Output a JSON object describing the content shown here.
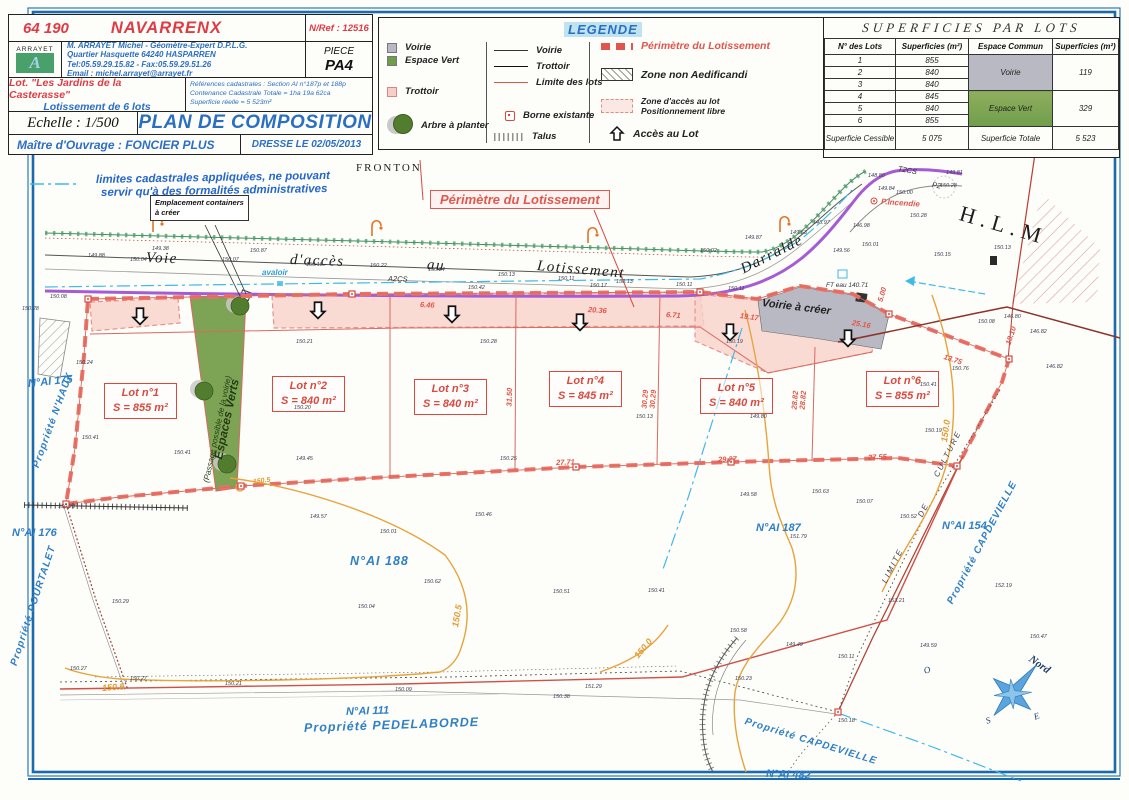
{
  "title_block": {
    "code": "64 190",
    "commune": "NAVARRENX",
    "nref": "N/Ref : 12516",
    "logo_text": "ARRAYET",
    "logo_letter": "A",
    "surveyor_line1": "M. ARRAYET Michel - Géomètre-Expert D.P.L.G.",
    "surveyor_line2": "Quartier Hasquette 64240 HASPARREN",
    "surveyor_line3": "Tel:05.59.29.15.82 - Fax:05.59.29.51.26",
    "surveyor_line4": "Email : michel.arrayet@arrayet.fr",
    "piece_label": "PIECE",
    "piece_value": "PA4",
    "lot_name": "Lot. \"Les Jardins de la Casterasse\"",
    "lot_sub": "Lotissement de 6 lots",
    "cadastre_line1": "Références cadastrales : Section AI n°187p et 188p",
    "cadastre_line2": "Contenance Cadastrale Totale = 1ha 19a 62ca",
    "cadastre_line3": "Superficie réelle = 5 523m²",
    "echelle": "Echelle : 1/500",
    "doc_title": "PLAN DE COMPOSITION",
    "client": "Maître d'Ouvrage : FONCIER PLUS",
    "date": "DRESSE LE 02/05/2013"
  },
  "legend": {
    "title": "LEGENDE",
    "col1": [
      {
        "label": "Voirie"
      },
      {
        "label": "Espace Vert"
      },
      {
        "label": "Trottoir"
      },
      {
        "label": "Arbre à planter"
      }
    ],
    "col2": [
      {
        "label": "Voirie"
      },
      {
        "label": "Trottoir"
      },
      {
        "label": "Limite des lots"
      },
      {
        "label": "Borne existante"
      },
      {
        "label": "Talus"
      }
    ],
    "col3": [
      {
        "label": "Périmètre du Lotissement"
      },
      {
        "label": "Zone non Aedificandi"
      },
      {
        "label": "Zone d'accès au lot",
        "label2": "Positionnement libre"
      },
      {
        "label": "Accès au Lot"
      }
    ]
  },
  "table": {
    "title": "SUPERFICIES PAR LOTS",
    "headers": [
      "N° des Lots",
      "Superficies (m²)",
      "Espace Commun",
      "Superficies (m²)"
    ],
    "rows": [
      [
        "1",
        "855"
      ],
      [
        "2",
        "840"
      ],
      [
        "3",
        "840"
      ],
      [
        "4",
        "845"
      ],
      [
        "5",
        "840"
      ],
      [
        "6",
        "855"
      ]
    ],
    "voirie_label": "Voirie",
    "voirie_value": "119",
    "ev_label": "Espace Vert",
    "ev_value": "329",
    "cessible_label": "Superficie Cessible",
    "cessible_value": "5 075",
    "totale_label": "Superficie Totale",
    "totale_value": "5 523"
  },
  "plan": {
    "containers_line1": "Emplacement containers",
    "containers_line2": "à créer",
    "perimetre_label": "Périmètre du Lotissement",
    "lots": [
      {
        "name": "Lot n°1",
        "area": "S = 855 m²",
        "x": 104,
        "y": 383
      },
      {
        "name": "Lot n°2",
        "area": "S = 840 m²",
        "x": 272,
        "y": 376
      },
      {
        "name": "Lot n°3",
        "area": "S = 840 m²",
        "x": 414,
        "y": 379
      },
      {
        "name": "Lot n°4",
        "area": "S = 845 m²",
        "x": 549,
        "y": 371
      },
      {
        "name": "Lot n°5",
        "area": "S = 840 m²",
        "x": 700,
        "y": 378
      },
      {
        "name": "Lot n°6",
        "area": "S = 855 m²",
        "x": 866,
        "y": 371
      }
    ],
    "labels": [
      {
        "t": "FRONTON",
        "x": 356,
        "y": 162,
        "r": 0,
        "c": "serifcap",
        "n": "fronton-label"
      },
      {
        "t": "limites cadastrales appliquées, ne pouvant",
        "x": 96,
        "y": 174,
        "r": -1,
        "c": "note",
        "n": "cadastral-note-line1"
      },
      {
        "t": "servir qu'à des formalités administratives",
        "x": 101,
        "y": 187,
        "r": -1,
        "c": "note",
        "n": "cadastral-note-line2"
      },
      {
        "t": "Voie",
        "x": 146,
        "y": 250,
        "r": 2,
        "c": "road",
        "n": "road-name"
      },
      {
        "t": "d'accès",
        "x": 290,
        "y": 252,
        "r": 2,
        "c": "road",
        "n": "road-name"
      },
      {
        "t": "au",
        "x": 427,
        "y": 257,
        "r": 4,
        "c": "road",
        "n": "road-name"
      },
      {
        "t": "Lotissement",
        "x": 537,
        "y": 258,
        "r": 5,
        "c": "road",
        "n": "road-name"
      },
      {
        "t": "Darralde",
        "x": 742,
        "y": 262,
        "r": -27,
        "c": "road",
        "n": "road-name-darralde"
      },
      {
        "t": "A2CS",
        "x": 388,
        "y": 274,
        "r": 2,
        "c": "tinyital",
        "n": "network-label"
      },
      {
        "t": "T2CS",
        "x": 898,
        "y": 164,
        "r": 10,
        "c": "tinyital",
        "n": "network-label"
      },
      {
        "t": "P2",
        "x": 932,
        "y": 180,
        "r": 10,
        "c": "tinyital",
        "n": "network-label"
      },
      {
        "t": "P.Incendie",
        "x": 881,
        "y": 197,
        "r": 4,
        "c": "redtiny",
        "n": "hydrant-label"
      },
      {
        "t": "H.L.M",
        "x": 960,
        "y": 200,
        "r": 16,
        "c": "hlm",
        "n": "hlm-label"
      },
      {
        "t": "Voirie à créer",
        "x": 762,
        "y": 297,
        "r": 7,
        "c": "voirie-creer",
        "n": "voirie-a-creer-label"
      },
      {
        "t": "avaloir",
        "x": 262,
        "y": 268,
        "r": 0,
        "c": "bluetiny",
        "n": "avaloir-label"
      },
      {
        "t": "FT eau 140.71",
        "x": 826,
        "y": 282,
        "r": 0,
        "c": "microital",
        "n": "ft-eau-label"
      },
      {
        "t": "Espaces Verts",
        "x": 218,
        "y": 452,
        "r": -78,
        "c": "ev1",
        "n": "espaces-verts-label"
      },
      {
        "t": "(Passage possible de la voirie)",
        "x": 206,
        "y": 478,
        "r": -78,
        "c": "ev2",
        "n": "espaces-verts-sublabel"
      },
      {
        "t": "N°AI 175",
        "x": 28,
        "y": 378,
        "r": -6,
        "c": "blue",
        "n": "parcel-number"
      },
      {
        "t": "Propriété N'HAUX",
        "x": 36,
        "y": 462,
        "r": -70,
        "c": "blue-rot",
        "n": "property-label"
      },
      {
        "t": "N°AI 176",
        "x": 12,
        "y": 527,
        "r": 0,
        "c": "blue",
        "n": "parcel-number"
      },
      {
        "t": "Propriété POURTALET",
        "x": 14,
        "y": 660,
        "r": -72,
        "c": "blue-rot",
        "n": "property-label"
      },
      {
        "t": "N°AI 188",
        "x": 350,
        "y": 554,
        "r": 0,
        "c": "blue-lg",
        "n": "parcel-number"
      },
      {
        "t": "N°AI 187",
        "x": 756,
        "y": 522,
        "r": 0,
        "c": "blue",
        "n": "parcel-number"
      },
      {
        "t": "N°AI 154",
        "x": 942,
        "y": 520,
        "r": 0,
        "c": "blue",
        "n": "parcel-number"
      },
      {
        "t": "Propriété CAPDEVIELLE",
        "x": 950,
        "y": 598,
        "r": -62,
        "c": "blue-rot",
        "n": "property-label"
      },
      {
        "t": "N°AI 111",
        "x": 346,
        "y": 706,
        "r": -2,
        "c": "blue",
        "n": "parcel-number"
      },
      {
        "t": "Propriété  PEDELABORDE",
        "x": 304,
        "y": 721,
        "r": -2,
        "c": "blue-lg",
        "n": "property-label"
      },
      {
        "t": "Propriété CAPDEVIELLE",
        "x": 745,
        "y": 716,
        "r": 17,
        "c": "blue-rot",
        "n": "property-label"
      },
      {
        "t": "N°AI 482",
        "x": 766,
        "y": 768,
        "r": 2,
        "c": "blue",
        "n": "parcel-number"
      },
      {
        "t": "LIMITE",
        "x": 884,
        "y": 578,
        "r": -63,
        "c": "culture",
        "n": "limite-culture-label"
      },
      {
        "t": "DE",
        "x": 920,
        "y": 512,
        "r": -63,
        "c": "culture",
        "n": "limite-culture-label"
      },
      {
        "t": "CULTURE",
        "x": 936,
        "y": 472,
        "r": -63,
        "c": "culture",
        "n": "limite-culture-label"
      },
      {
        "t": "Nord",
        "x": 1030,
        "y": 652,
        "r": 35,
        "c": "nord",
        "n": "compass-north-label"
      },
      {
        "t": "O",
        "x": 924,
        "y": 666,
        "r": -20,
        "c": "cletter",
        "n": "compass-west-label"
      },
      {
        "t": "S",
        "x": 986,
        "y": 716,
        "r": -20,
        "c": "cletter",
        "n": "compass-south-label"
      },
      {
        "t": "E",
        "x": 1034,
        "y": 712,
        "r": -20,
        "c": "cletter",
        "n": "compass-east-label"
      },
      {
        "t": "150.5",
        "x": 102,
        "y": 683,
        "r": -4,
        "c": "orange",
        "n": "contour-label"
      },
      {
        "t": "150.5",
        "x": 253,
        "y": 479,
        "r": -8,
        "c": "orange-sm",
        "n": "contour-label"
      },
      {
        "t": "150.5",
        "x": 455,
        "y": 622,
        "r": -80,
        "c": "orange",
        "n": "contour-label"
      },
      {
        "t": "150.0",
        "x": 944,
        "y": 437,
        "r": -82,
        "c": "orange",
        "n": "contour-label"
      },
      {
        "t": "150.0",
        "x": 636,
        "y": 652,
        "r": -50,
        "c": "orange",
        "n": "contour-label"
      },
      {
        "t": "6.46",
        "x": 420,
        "y": 300,
        "r": 3,
        "c": "dim",
        "n": "dimension"
      },
      {
        "t": "20.36",
        "x": 588,
        "y": 305,
        "r": 4,
        "c": "dim",
        "n": "dimension"
      },
      {
        "t": "6.71",
        "x": 666,
        "y": 310,
        "r": 4,
        "c": "dim",
        "n": "dimension"
      },
      {
        "t": "19.17",
        "x": 740,
        "y": 311,
        "r": 8,
        "c": "dim",
        "n": "dimension"
      },
      {
        "t": "25.16",
        "x": 852,
        "y": 318,
        "r": 10,
        "c": "dim",
        "n": "dimension"
      },
      {
        "t": "13.75",
        "x": 944,
        "y": 352,
        "r": 18,
        "c": "dim",
        "n": "dimension"
      },
      {
        "t": "18.10",
        "x": 1008,
        "y": 340,
        "r": -72,
        "c": "dim",
        "n": "dimension"
      },
      {
        "t": "31.50",
        "x": 509,
        "y": 402,
        "r": -88,
        "c": "dim",
        "n": "dimension"
      },
      {
        "t": "30.29",
        "x": 644,
        "y": 404,
        "r": -85,
        "c": "dim",
        "n": "dimension"
      },
      {
        "t": "30.29",
        "x": 652,
        "y": 404,
        "r": -85,
        "c": "dim",
        "n": "dimension"
      },
      {
        "t": "28.82",
        "x": 794,
        "y": 405,
        "r": -85,
        "c": "dim",
        "n": "dimension"
      },
      {
        "t": "28.82",
        "x": 802,
        "y": 405,
        "r": -85,
        "c": "dim",
        "n": "dimension"
      },
      {
        "t": "27.71",
        "x": 556,
        "y": 458,
        "r": -2,
        "c": "dim",
        "n": "dimension"
      },
      {
        "t": "29.27",
        "x": 718,
        "y": 455,
        "r": -2,
        "c": "dim",
        "n": "dimension"
      },
      {
        "t": "27.55",
        "x": 868,
        "y": 453,
        "r": -3,
        "c": "dim",
        "n": "dimension"
      },
      {
        "t": "5.00",
        "x": 880,
        "y": 297,
        "r": -74,
        "c": "dim",
        "n": "dimension"
      }
    ],
    "spots": [
      [
        88,
        254,
        "149.88"
      ],
      [
        130,
        258,
        "150.04"
      ],
      [
        152,
        247,
        "149.38"
      ],
      [
        222,
        258,
        "150.07"
      ],
      [
        250,
        249,
        "150.87"
      ],
      [
        306,
        263,
        "150.18"
      ],
      [
        370,
        264,
        "150.22"
      ],
      [
        428,
        268,
        "150.24"
      ],
      [
        468,
        286,
        "150.42"
      ],
      [
        498,
        273,
        "150.13"
      ],
      [
        558,
        277,
        "150.11"
      ],
      [
        590,
        284,
        "150.17"
      ],
      [
        616,
        280,
        "150.13"
      ],
      [
        676,
        283,
        "150.11"
      ],
      [
        700,
        249,
        "150.02"
      ],
      [
        728,
        287,
        "150.11"
      ],
      [
        745,
        236,
        "149.87"
      ],
      [
        790,
        231,
        "149.53"
      ],
      [
        813,
        221,
        "148.97"
      ],
      [
        833,
        249,
        "149.56"
      ],
      [
        853,
        224,
        "146.98"
      ],
      [
        862,
        243,
        "150.01"
      ],
      [
        878,
        187,
        "149.84"
      ],
      [
        896,
        191,
        "150.00"
      ],
      [
        910,
        214,
        "150.28"
      ],
      [
        868,
        174,
        "148.80"
      ],
      [
        946,
        171,
        "149.81"
      ],
      [
        934,
        253,
        "150.15"
      ],
      [
        994,
        246,
        "150.13"
      ],
      [
        940,
        184,
        "150.28"
      ],
      [
        50,
        295,
        "150.08"
      ],
      [
        22,
        307,
        "150.28"
      ],
      [
        76,
        361,
        "150.24"
      ],
      [
        82,
        436,
        "150.41"
      ],
      [
        58,
        505,
        "150.23"
      ],
      [
        296,
        340,
        "150.21"
      ],
      [
        480,
        340,
        "150.28"
      ],
      [
        726,
        340,
        "150.19"
      ],
      [
        294,
        406,
        "150.20"
      ],
      [
        636,
        415,
        "150.13"
      ],
      [
        750,
        415,
        "149.80"
      ],
      [
        925,
        429,
        "150.19"
      ],
      [
        174,
        451,
        "150.41"
      ],
      [
        296,
        457,
        "149.45"
      ],
      [
        500,
        457,
        "150.25"
      ],
      [
        740,
        493,
        "149.58"
      ],
      [
        812,
        490,
        "150.63"
      ],
      [
        856,
        500,
        "150.07"
      ],
      [
        900,
        515,
        "150.52"
      ],
      [
        1004,
        315,
        "146.80"
      ],
      [
        978,
        320,
        "150.08"
      ],
      [
        1030,
        330,
        "146.82"
      ],
      [
        1046,
        365,
        "146.82"
      ],
      [
        310,
        515,
        "149.57"
      ],
      [
        380,
        530,
        "150.01"
      ],
      [
        475,
        513,
        "150.46"
      ],
      [
        553,
        590,
        "150.51"
      ],
      [
        358,
        605,
        "150.04"
      ],
      [
        112,
        600,
        "150.29"
      ],
      [
        424,
        580,
        "150.62"
      ],
      [
        553,
        695,
        "150.38"
      ],
      [
        648,
        589,
        "150.41"
      ],
      [
        790,
        535,
        "151.79"
      ],
      [
        70,
        667,
        "150.27"
      ],
      [
        130,
        677,
        "150.27"
      ],
      [
        225,
        682,
        "150.21"
      ],
      [
        395,
        688,
        "150.09"
      ],
      [
        585,
        685,
        "151.29"
      ],
      [
        735,
        677,
        "150.23"
      ],
      [
        838,
        719,
        "150.18"
      ],
      [
        888,
        599,
        "153.21"
      ],
      [
        920,
        644,
        "149.59"
      ],
      [
        1030,
        635,
        "150.47"
      ],
      [
        730,
        629,
        "150.58"
      ],
      [
        786,
        643,
        "149.49"
      ],
      [
        838,
        655,
        "150.11"
      ],
      [
        995,
        584,
        "152.19"
      ],
      [
        952,
        367,
        "150.76"
      ],
      [
        920,
        383,
        "150.41"
      ]
    ]
  }
}
